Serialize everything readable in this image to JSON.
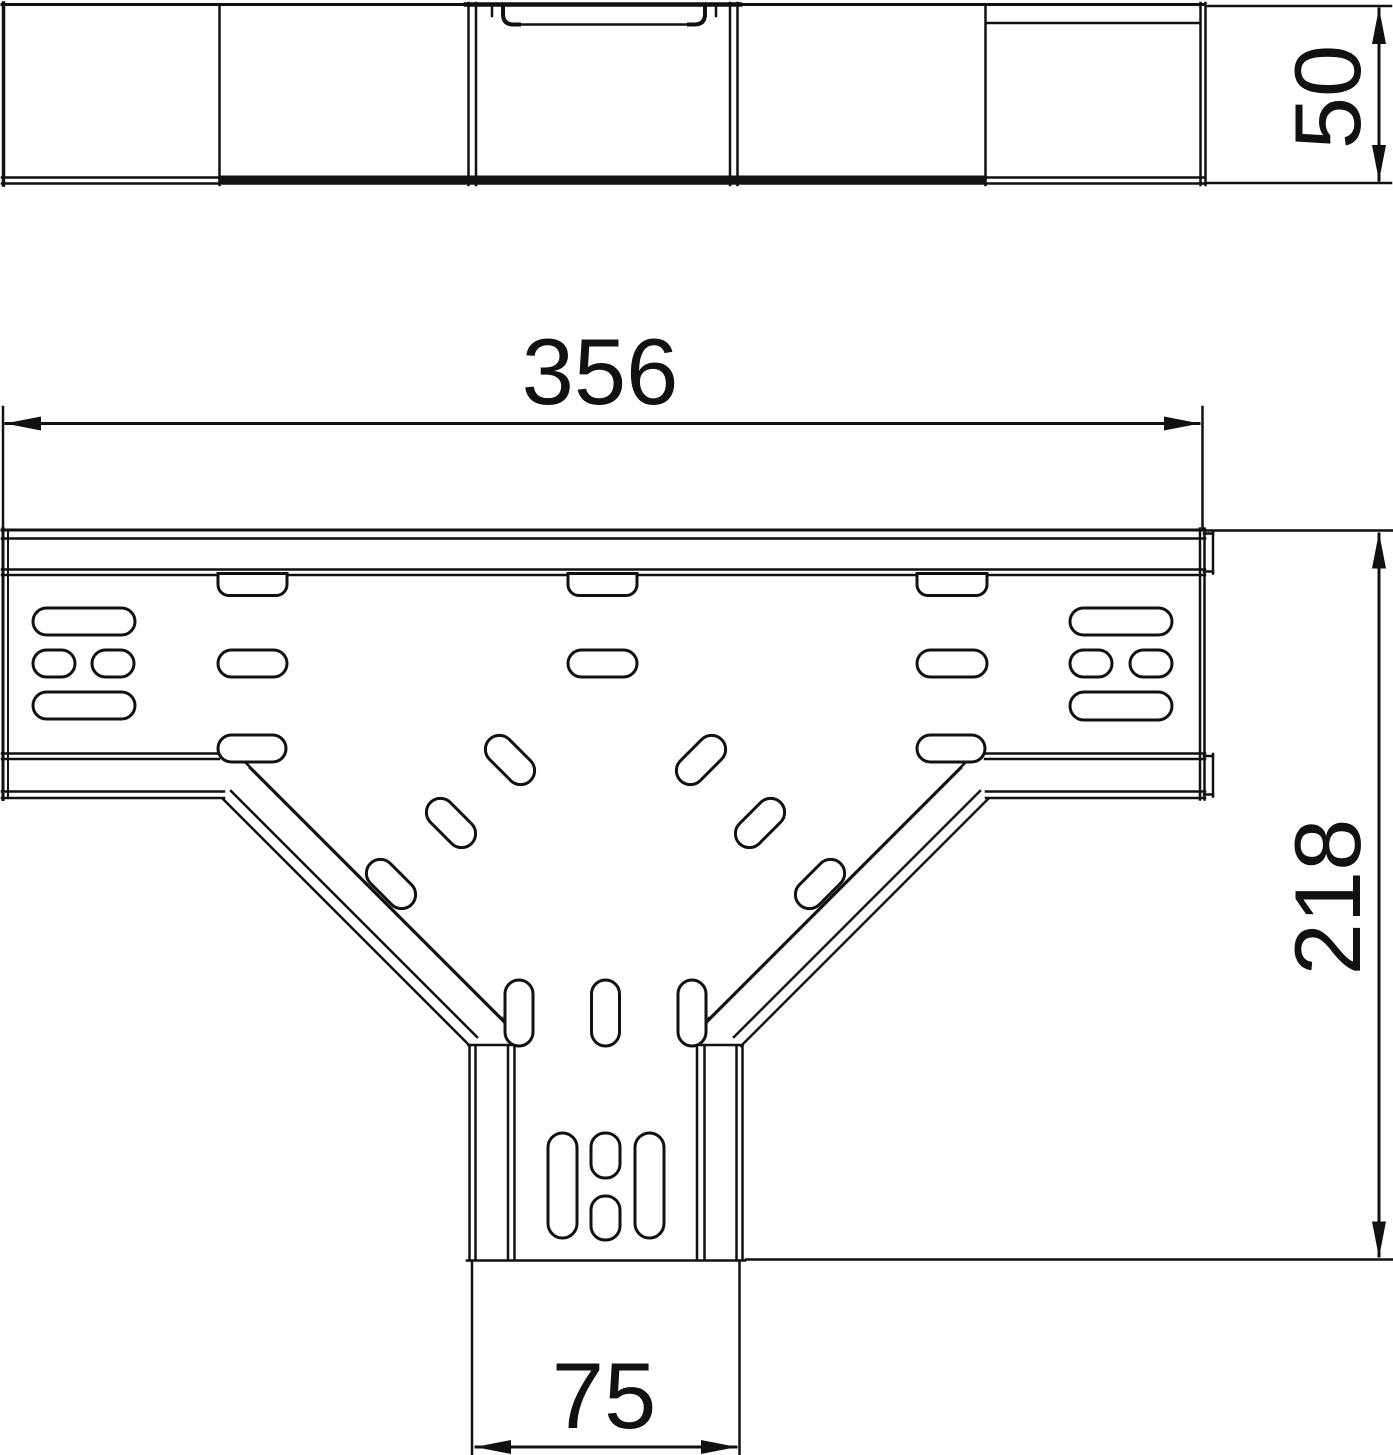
{
  "drawing": {
    "title": "Cable tray T-branch piece — dimensioned technical drawing",
    "background_color": "#ffffff",
    "line_color": "#111111",
    "views": {
      "side_view": {
        "label": "side-elevation"
      },
      "plan_view": {
        "label": "plan-view-t-piece"
      }
    },
    "dimensions": {
      "side_height": {
        "value": "50"
      },
      "overall_width": {
        "value": "356"
      },
      "branch_depth": {
        "value": "218"
      },
      "branch_width": {
        "value": "75"
      }
    }
  }
}
